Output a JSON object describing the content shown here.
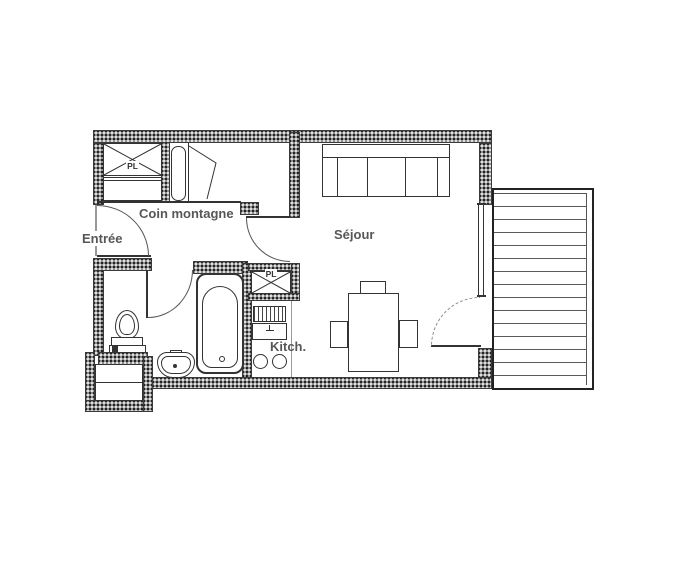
{
  "plan_title": "Studio floor plan",
  "rooms": {
    "entree": {
      "label": "Entrée"
    },
    "coin_montagne": {
      "label": "Coin montagne"
    },
    "sejour": {
      "label": "Séjour"
    },
    "kitchen": {
      "label": "Kitch."
    }
  },
  "closets": {
    "coin_pl": {
      "label": "PL"
    },
    "kitchen_pl": {
      "label": "PL"
    }
  },
  "colors": {
    "wall_fill": "#909090",
    "line": "#333333",
    "label_text": "#575757"
  }
}
